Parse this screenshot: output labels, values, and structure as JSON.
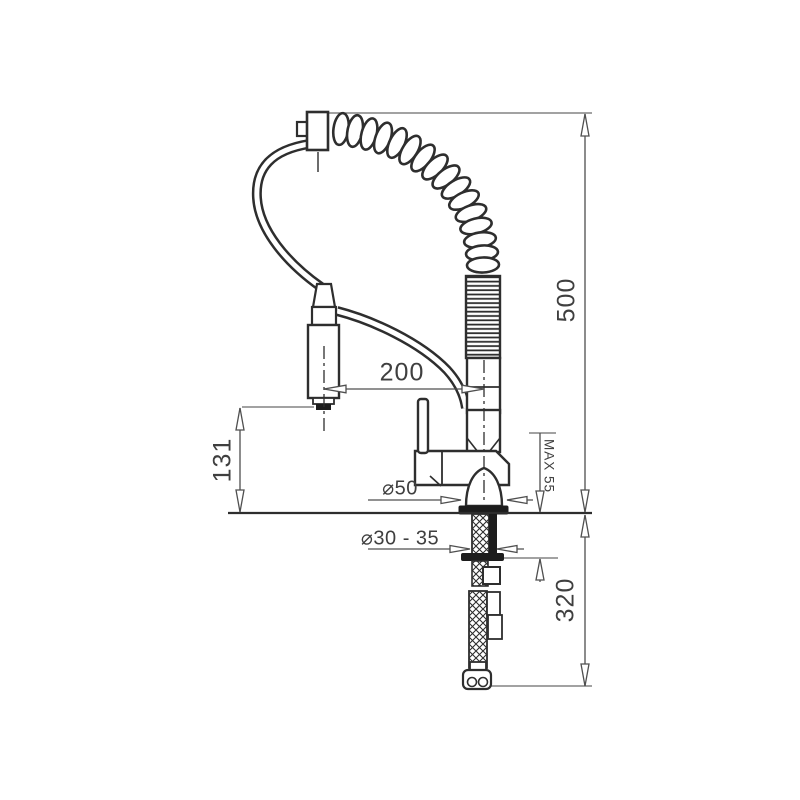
{
  "page": {
    "background": "#ffffff"
  },
  "drawing": {
    "type": "technical-dimension-drawing",
    "subject": "pull-out spring kitchen mixer tap, side elevation with installation dimensions",
    "colors": {
      "object_line": "#2e2e2e",
      "dimension_line": "#4f4f4f",
      "text": "#3f3f3f",
      "fill": "#ffffff",
      "solid_detail": "#1c1c1c"
    },
    "labels": {
      "total_height": "500",
      "hose_below_counter": "320",
      "spout_clearance": "131",
      "spout_reach": "200",
      "max_counter_thickness": "MAX 55",
      "base_diameter": "⌀50",
      "mounting_hole_diameter": "⌀30 - 35"
    }
  }
}
